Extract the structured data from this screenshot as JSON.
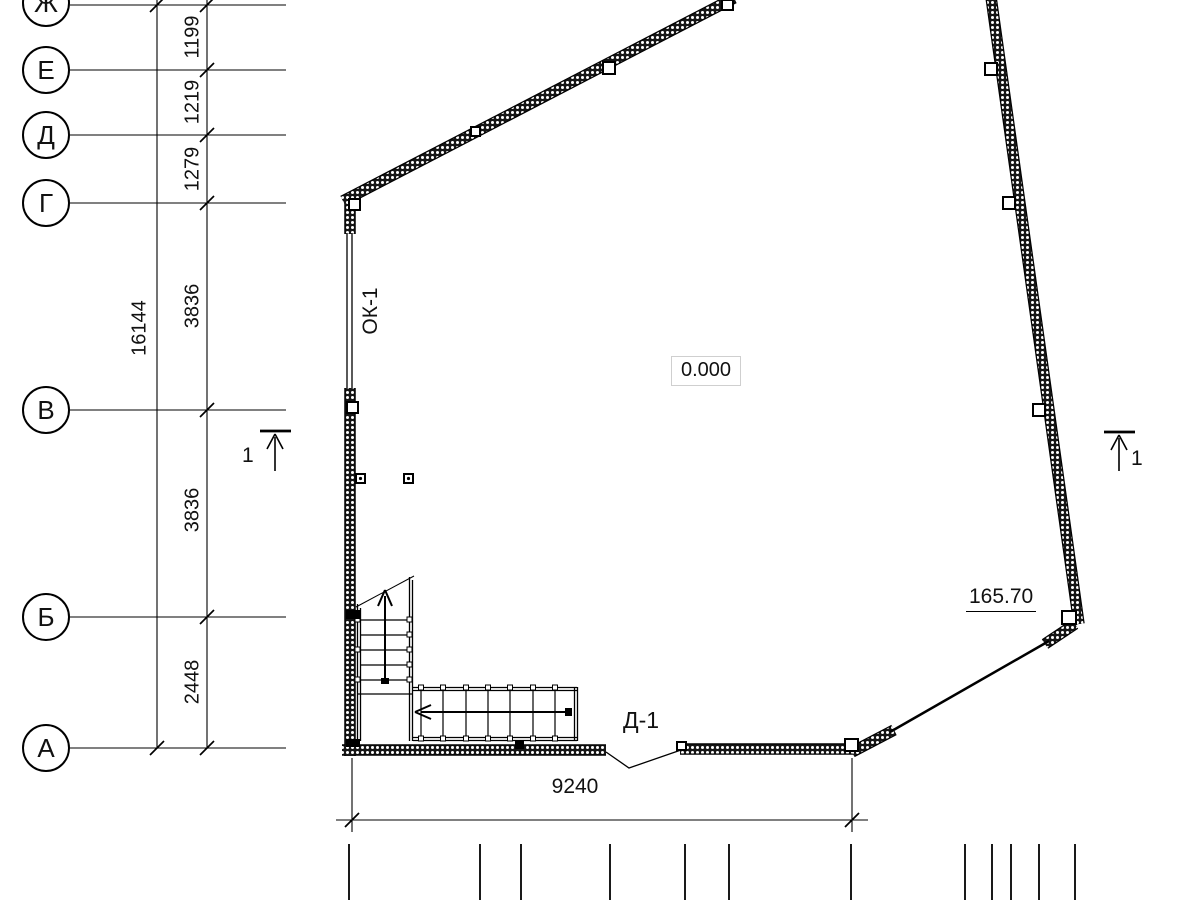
{
  "axes": {
    "rows": [
      {
        "label": "Ж"
      },
      {
        "label": "Е"
      },
      {
        "label": "Д"
      },
      {
        "label": "Г"
      },
      {
        "label": "В"
      },
      {
        "label": "Б"
      },
      {
        "label": "А"
      }
    ]
  },
  "dimensions": {
    "vertical_overall": "16144",
    "vertical_segments": [
      "1199",
      "1219",
      "1279",
      "3836",
      "3836",
      "2448"
    ],
    "bottom_width": "9240"
  },
  "labels": {
    "window_mark": "ОК-1",
    "level_mark": "0.000",
    "elevation_mark": "165.70",
    "door_mark": "Д-1",
    "section_cut_left": "1",
    "section_cut_right": "1"
  }
}
